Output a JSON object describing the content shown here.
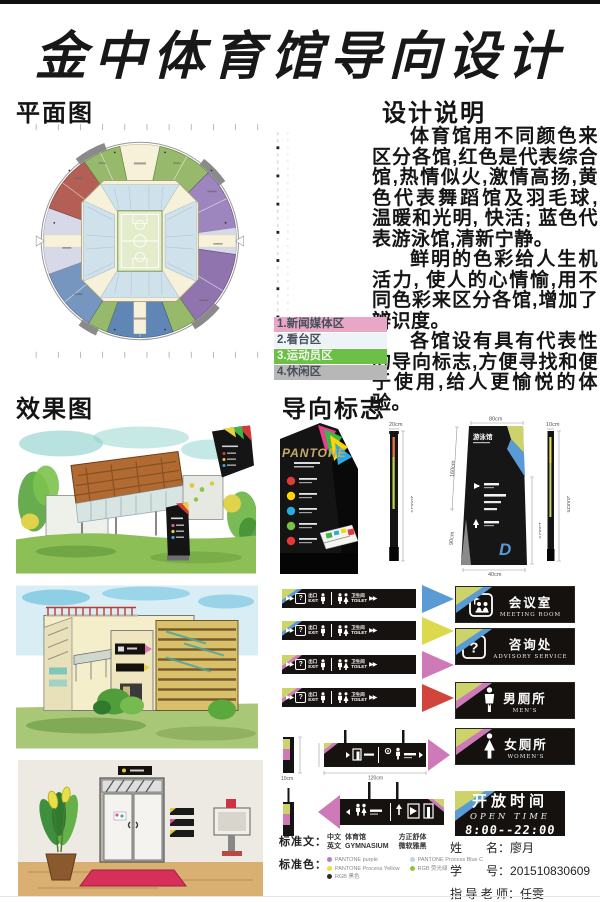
{
  "title": "金中体育馆导向设计",
  "floor_plan": {
    "heading": "平面图",
    "legend": [
      {
        "num": "1.",
        "label": "新闻媒体区",
        "color": "#e8a7c6"
      },
      {
        "num": "2.",
        "label": "看台区",
        "color": "#edf4f8"
      },
      {
        "num": "3.",
        "label": "运动员区",
        "color": "#6cbf47"
      },
      {
        "num": "4.",
        "label": "休闲区",
        "color": "#b7b7b7"
      }
    ]
  },
  "design_notes": {
    "heading": "设计说明",
    "p1": "体育馆用不同颜色来区分各馆,红色是代表综合馆,热情似火,激情高扬,黄色代表舞蹈馆及羽毛球, 温暖和光明, 快活; 蓝色代表游泳馆,清新宁静。",
    "p2": "鲜明的色彩给人生机活力, 使人的心情愉,用不同色彩来区分各馆,增加了辨识度。",
    "p3": "各馆设有具有代表性的导向标志,方便寻找和便于使用,给人更愉悦的体验。"
  },
  "renderings": {
    "heading": "效果图"
  },
  "signage": {
    "heading": "导向标志",
    "brand": "PANTONE",
    "logo_glyph": "D",
    "totem_title": "游泳馆",
    "dims": {
      "t1_top": "20cm",
      "t1_h": "200cm",
      "t2_top": "80cm",
      "t2_left": "160cm",
      "t2_ll": "90cm",
      "t2_right": "130cm",
      "t2_bottom": "40cm",
      "t3_top": "10cm",
      "t3_h": "200cm",
      "hang_h": "50cm",
      "hang_w": "120cm",
      "side_w": "10cm"
    },
    "wall_sign": {
      "arrows": "▶▶",
      "q": "?",
      "exit_cn": "出口",
      "exit_en": "EXIT",
      "wc_cn": "卫生间",
      "wc_en": "TOILET"
    },
    "triangle_colors": [
      "#5b9bd5",
      "#ddd94e",
      "#cf7ab8",
      "#d0453c"
    ],
    "corner_accents": [
      "#5b9bd5",
      "#5b9bd5",
      "#cf7ab8",
      "#cf7ab8"
    ],
    "room_signs": [
      {
        "cn": "会议室",
        "en": "MEETING ROOM",
        "accent": "#5b9bd5"
      },
      {
        "cn": "咨询处",
        "en": "ADVISORY SERVICE",
        "accent": "#5b9bd5"
      },
      {
        "cn": "男厕所",
        "en": "MEN'S",
        "accent": "#cf7ab8"
      },
      {
        "cn": "女厕所",
        "en": "WOMEN'S",
        "accent": "#cf7ab8"
      }
    ],
    "open_time": {
      "cn": "开放时间",
      "en": "OPEN TIME",
      "hours": "8:00--22:00"
    }
  },
  "standards": {
    "text_label": "标准文：",
    "color_label": "标准色：",
    "cn_key": "中文",
    "cn_val": "体育馆",
    "en_key": "英文",
    "en_val": "GYMNASIUM",
    "font_cn": "方正舒体",
    "font_en": "微软雅黑",
    "colors": [
      {
        "hex": "#b57bc8",
        "label": "PANTONE purple"
      },
      {
        "hex": "#f2dc3c",
        "label": "PANTONE Process Yellow"
      },
      {
        "hex": "#2b2b2b",
        "label": "RGB 黑色"
      },
      {
        "hex": "#bcd6ec",
        "label": "PANTONE Process Blue C"
      },
      {
        "hex": "#8cc63f",
        "label": "RGB 荧光绿"
      }
    ]
  },
  "credits": {
    "name_label": "姓　　名：",
    "name": "廖月",
    "id_label": "学　　号：",
    "id": "201510830609",
    "teacher_label": "指 导 老 师：",
    "teacher": "任雯"
  }
}
